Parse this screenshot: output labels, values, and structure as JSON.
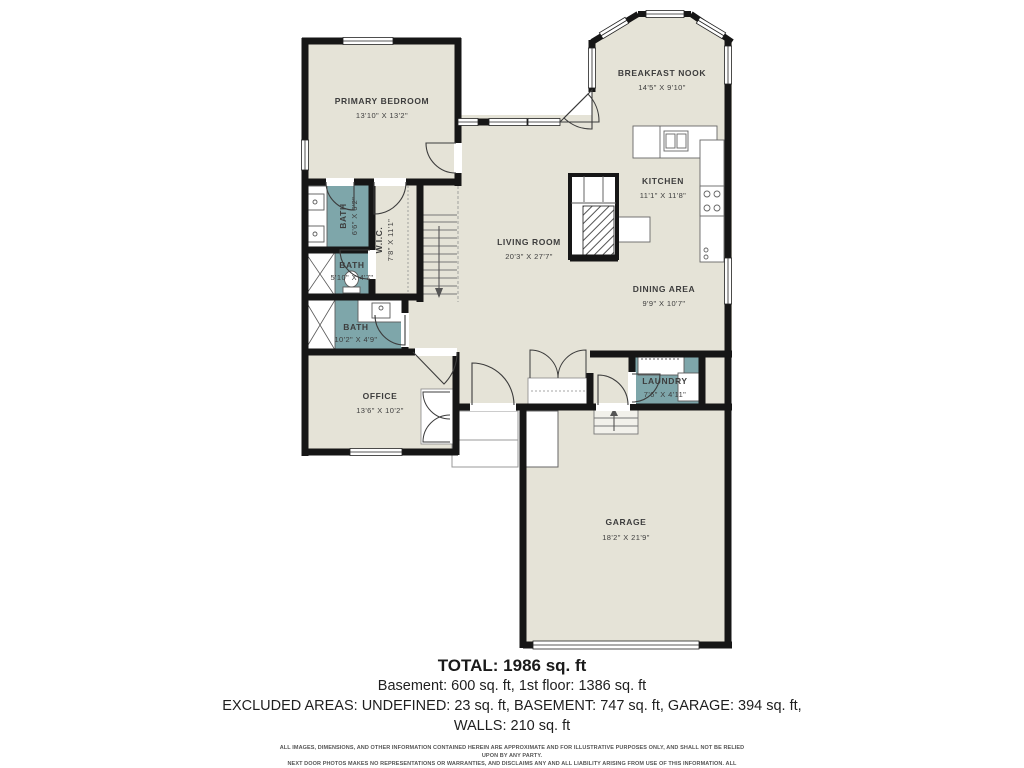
{
  "plan": {
    "rooms": {
      "primary_bedroom": {
        "name": "PRIMARY BEDROOM",
        "dims": "13'10\" X 13'2\""
      },
      "breakfast_nook": {
        "name": "BREAKFAST NOOK",
        "dims": "14'5\" X 9'10\""
      },
      "kitchen": {
        "name": "KITCHEN",
        "dims": "11'1\" X 11'8\""
      },
      "living_room": {
        "name": "LIVING ROOM",
        "dims": "20'3\" X 27'7\""
      },
      "dining_area": {
        "name": "DINING AREA",
        "dims": "9'9\" X 10'7\""
      },
      "laundry": {
        "name": "LAUNDRY",
        "dims": "7'6\" X 4'11\""
      },
      "office": {
        "name": "OFFICE",
        "dims": "13'6\" X 10'2\""
      },
      "garage": {
        "name": "GARAGE",
        "dims": "18'2\" X 21'9\""
      },
      "bath_primary": {
        "name": "BATH",
        "dims": "6'6\" X 6'2\""
      },
      "bath_hall": {
        "name": "BATH",
        "dims": "5'10\" X 4'7\""
      },
      "bath_third": {
        "name": "BATH",
        "dims": "10'2\" X 4'9\""
      },
      "wic": {
        "name": "W.I.C.",
        "dims": "7'8\" X 11'1\""
      }
    }
  },
  "colors": {
    "floor": "#e5e3d7",
    "bath": "#7ea6aa",
    "wall": "#161616"
  },
  "summary": {
    "total": "TOTAL: 1986 sq. ft",
    "floors": "Basement: 600 sq. ft, 1st floor: 1386 sq. ft",
    "excluded": "EXCLUDED AREAS: UNDEFINED: 23 sq. ft, BASEMENT: 747 sq. ft, GARAGE: 394 sq. ft,",
    "walls": "WALLS: 210 sq. ft"
  },
  "disclaimer": {
    "line1": "ALL IMAGES, DIMENSIONS, AND OTHER INFORMATION CONTAINED HEREIN ARE APPROXIMATE AND FOR ILLUSTRATIVE PURPOSES ONLY, AND SHALL NOT BE RELIED UPON BY ANY PARTY.",
    "line2": "NEXT DOOR PHOTOS MAKES NO REPRESENTATIONS OR WARRANTIES, AND DISCLAIMS ANY AND ALL LIABILITY ARISING FROM USE OF THIS INFORMATION. ALL INFORMATION HEREIN",
    "line3": "SHALL BE SUBJECT TO THE TERMS AND CONDITIONS FOUND AT NEXTDOORPHOTOS.COM/TC."
  }
}
